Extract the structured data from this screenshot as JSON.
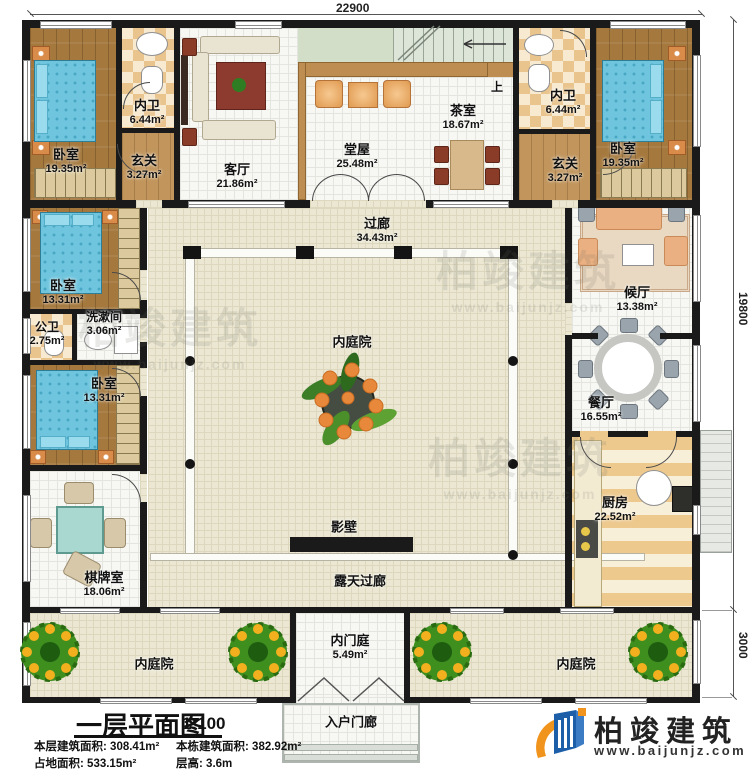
{
  "dimensions": {
    "top": "22900",
    "right_main": "19800",
    "right_lower": "3000"
  },
  "rooms": {
    "bedroom_tl": {
      "name": "卧室",
      "area": "19.35m²"
    },
    "bath_tl": {
      "name": "内卫",
      "area": "6.44m²"
    },
    "foyer_tl": {
      "name": "玄关",
      "area": "3.27m²"
    },
    "living": {
      "name": "客厅",
      "area": "21.86m²"
    },
    "hall": {
      "name": "堂屋",
      "area": "25.48m²"
    },
    "tea": {
      "name": "茶室",
      "area": "18.67m²"
    },
    "bath_tr": {
      "name": "内卫",
      "area": "6.44m²"
    },
    "foyer_tr": {
      "name": "玄关",
      "area": "3.27m²"
    },
    "bedroom_tr": {
      "name": "卧室",
      "area": "19.35m²"
    },
    "corridor": {
      "name": "过廊",
      "area": "34.43m²"
    },
    "bedroom_l2": {
      "name": "卧室",
      "area": "13.31m²"
    },
    "public_bath": {
      "name": "公卫",
      "area": "2.75m²"
    },
    "washroom": {
      "name": "洗漱间",
      "area": "3.06m²"
    },
    "bedroom_l3": {
      "name": "卧室",
      "area": "13.31m²"
    },
    "chess_room": {
      "name": "棋牌室",
      "area": "18.06m²"
    },
    "waiting": {
      "name": "候厅",
      "area": "13.38m²"
    },
    "dining": {
      "name": "餐厅",
      "area": "16.55m²"
    },
    "kitchen": {
      "name": "厨房",
      "area": "22.52m²"
    },
    "inner_courtyard": {
      "name": "内庭院"
    },
    "screen_wall": {
      "name": "影壁"
    },
    "open_corridor": {
      "name": "露天过廊"
    },
    "courtyard_bl": {
      "name": "内庭院"
    },
    "courtyard_br": {
      "name": "内庭院"
    },
    "inner_gate": {
      "name": "内门庭",
      "area": "5.49m²"
    },
    "entry_porch": {
      "name": "入户门廊"
    },
    "stairs": {
      "up": "上"
    }
  },
  "title_block": {
    "title": "一层平面图",
    "scale": "1:100",
    "stats": [
      {
        "label": "本层建筑面积:",
        "value": "308.41m²"
      },
      {
        "label": "本栋建筑面积:",
        "value": "382.92m²"
      },
      {
        "label": "占地面积:",
        "value": "533.15m²"
      },
      {
        "label": "层高:",
        "value": "3.6m"
      }
    ]
  },
  "brand": {
    "name": "柏竣建筑",
    "site": "www.baijunjz.com"
  },
  "watermark": {
    "text": "柏竣建筑",
    "site": "www.baijunjz.com"
  },
  "colors": {
    "wall": "#1a1a1a",
    "brand_blue": "#1c5fa8",
    "brand_orange": "#f0941d",
    "bed_blue": "#6fc5dd"
  }
}
